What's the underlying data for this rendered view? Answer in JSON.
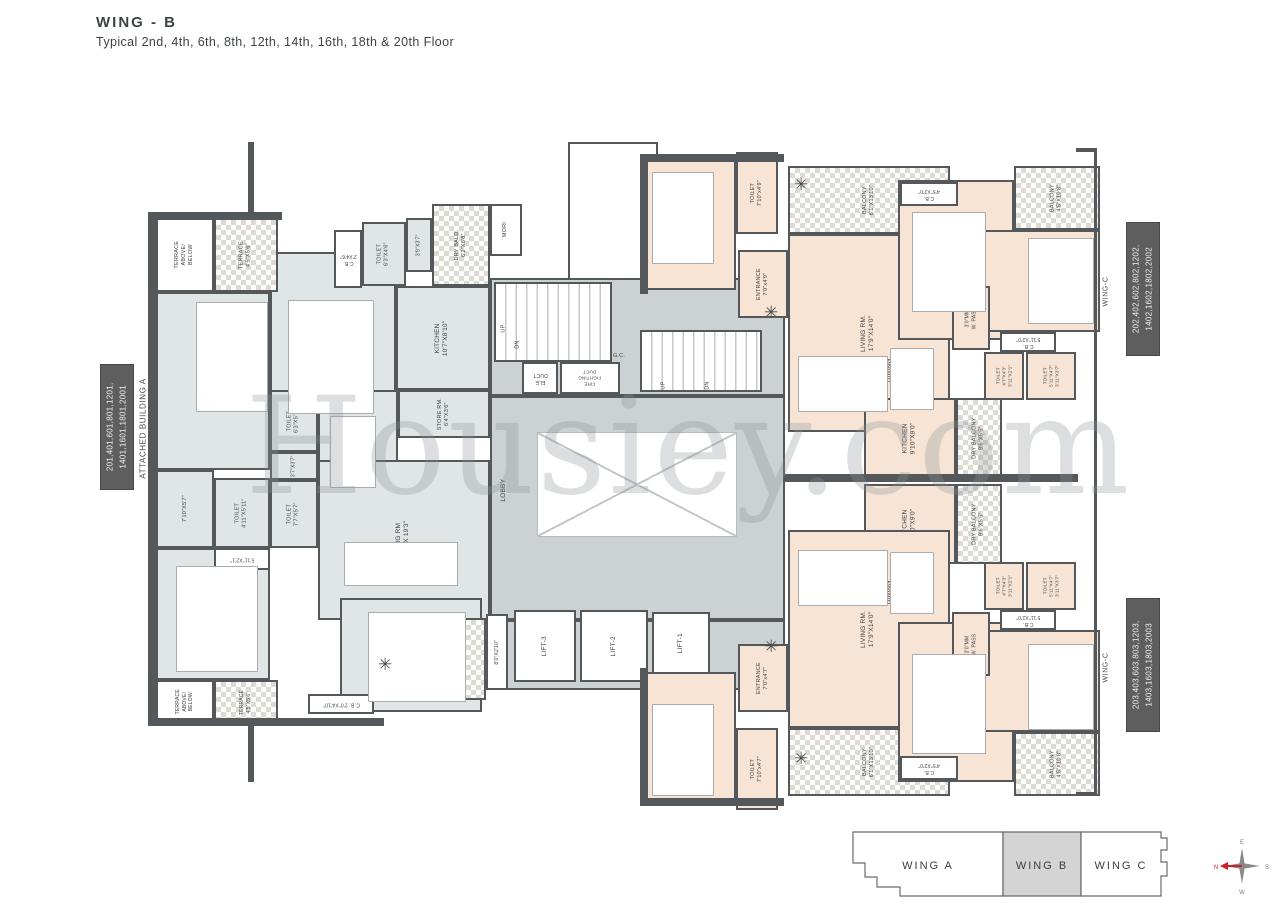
{
  "title": "WING - B",
  "subtitle": "Typical 2nd, 4th, 6th, 8th, 12th, 14th, 16th, 18th & 20th Floor",
  "watermark": "Housiey.com",
  "side_labels": {
    "left_units": "201,401,601,801,1201,\n1401,1601,1801,2001",
    "left_building": "ATTACHED BUILDING A",
    "right_top_units": "202,402,602,802,1202,\n1402,1602,1802,2002",
    "right_top_wing": "WING-C",
    "right_bottom_units": "203,403,603,803,1203,\n1403,1603,1803,2003",
    "right_bottom_wing": "WING-C"
  },
  "key_plan": {
    "wings": [
      {
        "label": "WING A",
        "active": false
      },
      {
        "label": "WING B",
        "active": true
      },
      {
        "label": "WING C",
        "active": false
      }
    ]
  },
  "compass": {
    "n": "N",
    "e": "E",
    "s": "S",
    "w": "W"
  },
  "colors": {
    "wall": "#54585a",
    "apartment_left_fill": "#e0e6e6",
    "apartment_right_fill": "#f7e4d5",
    "core_fill": "#ccd1d3",
    "unit_box": "#5e5e5e",
    "key_plan_active": "#d4d4d4",
    "compass_north": "#cc2222"
  },
  "plan": {
    "rooms": [
      {
        "n": "core-upper",
        "c": "core",
        "x": 490,
        "y": 278,
        "w": 295,
        "h": 118
      },
      {
        "n": "core-lobby",
        "c": "core",
        "x": 490,
        "y": 396,
        "w": 295,
        "h": 224
      },
      {
        "n": "core-lift-lobby",
        "c": "core",
        "x": 490,
        "y": 620,
        "w": 295,
        "h": 70
      },
      {
        "n": "kids-rm-01",
        "l": "KIDS RM.01\n14'0\"X12'0\"",
        "c": "aptL",
        "x": 156,
        "y": 292,
        "w": 114,
        "h": 178
      },
      {
        "n": "kids-rm-02",
        "l": "KIDS RM.02\n12'0\"X10'10\"",
        "c": "aptL",
        "x": 270,
        "y": 252,
        "w": 126,
        "h": 208
      },
      {
        "n": "kitchen",
        "l": "KITCHEN\n10'7\"X8'10\"",
        "c": "aptL",
        "x": 396,
        "y": 286,
        "w": 94,
        "h": 104
      },
      {
        "n": "dining",
        "l": "DINING\n11'0\"X9'11\"",
        "c": "aptL",
        "x": 318,
        "y": 390,
        "w": 80,
        "h": 100
      },
      {
        "n": "living-rm",
        "l": "LIVING RM\n20'4\" X 19'3\"",
        "c": "aptL",
        "x": 318,
        "y": 460,
        "w": 172,
        "h": 160
      },
      {
        "n": "m-bed-rm",
        "l": "M. BED RM\n14'0\"X12'0\"",
        "c": "aptL",
        "x": 156,
        "y": 548,
        "w": 114,
        "h": 132
      },
      {
        "n": "guest-bed-rm",
        "l": "GUEST BED RM\n12'4\"X10'8\"",
        "c": "aptL",
        "x": 340,
        "y": 598,
        "w": 142,
        "h": 114
      },
      {
        "n": "pass-master",
        "l": "7'10\"X5'7\"",
        "c": "aptL",
        "x": 156,
        "y": 470,
        "w": 58,
        "h": 78,
        "f": 5.5
      },
      {
        "n": "toilet-master",
        "l": "TOILET\n4'11\"X5'11\"",
        "c": "aptL",
        "x": 214,
        "y": 478,
        "w": 56,
        "h": 70,
        "f": 5.5
      },
      {
        "n": "cb-master",
        "l": "5'11\"X2'1\"",
        "c": "white",
        "x": 214,
        "y": 548,
        "w": 56,
        "h": 22,
        "r": 180,
        "f": 5
      },
      {
        "n": "toilet-common",
        "l": "TOILET\n6'3\"X5'7\"",
        "c": "aptL",
        "x": 270,
        "y": 390,
        "w": 48,
        "h": 62,
        "f": 5.5
      },
      {
        "n": "pass-toilets",
        "l": "3'7\"X3'7\"",
        "c": "aptL",
        "x": 270,
        "y": 452,
        "w": 48,
        "h": 28,
        "f": 5
      },
      {
        "n": "toilet-guest",
        "l": "TOILET\n7'7\"X5'7\"",
        "c": "aptL",
        "x": 270,
        "y": 480,
        "w": 48,
        "h": 68,
        "f": 5.5
      },
      {
        "n": "terrace-above-below-top",
        "l": "TERRACE\nABOVE/\nBELOW",
        "c": "white",
        "x": 156,
        "y": 218,
        "w": 58,
        "h": 74,
        "f": 5.5
      },
      {
        "n": "terrace-top",
        "l": "TERRACE\n4'5\"X5'6\"",
        "c": "hatch",
        "x": 214,
        "y": 218,
        "w": 64,
        "h": 74,
        "f": 5.5
      },
      {
        "n": "cb-kids",
        "l": "C.B.\n2'X4'6\"",
        "c": "white",
        "x": 334,
        "y": 230,
        "w": 28,
        "h": 58,
        "r": 180,
        "f": 5
      },
      {
        "n": "toilet-kids",
        "l": "TOILET\n6'3\"X4'6\"",
        "c": "aptL",
        "x": 362,
        "y": 222,
        "w": 44,
        "h": 64,
        "f": 5.5
      },
      {
        "n": "pass-kids",
        "l": "3'9\"X3'7\"",
        "c": "aptL",
        "x": 406,
        "y": 218,
        "w": 26,
        "h": 54,
        "f": 5
      },
      {
        "n": "dry-bald",
        "l": "DRY BALD.\n6'2\"X6'8\"",
        "c": "hatch",
        "x": 432,
        "y": 204,
        "w": 58,
        "h": 82,
        "f": 5.5
      },
      {
        "n": "mori",
        "l": "MORI",
        "c": "white",
        "x": 490,
        "y": 204,
        "w": 32,
        "h": 52,
        "f": 5.5
      },
      {
        "n": "store-rm",
        "l": "STORE RM.\n6'4\"X3'6\"",
        "c": "aptL",
        "x": 398,
        "y": 390,
        "w": 92,
        "h": 48,
        "f": 5.5
      },
      {
        "n": "terrace-above-below-bottom",
        "l": "TERRACE\nABOVE/\nBELOW",
        "c": "white",
        "x": 156,
        "y": 680,
        "w": 58,
        "h": 44,
        "f": 5
      },
      {
        "n": "terrace-bottom",
        "l": "TERRACE\n4'5\"X5'6\"",
        "c": "hatch",
        "x": 214,
        "y": 680,
        "w": 64,
        "h": 44,
        "f": 5
      },
      {
        "n": "cb-guest",
        "l": "C.B. 2'0\"X4'10\"",
        "c": "white",
        "x": 308,
        "y": 694,
        "w": 66,
        "h": 20,
        "r": 180,
        "f": 5
      },
      {
        "n": "balcony-left",
        "l": "BALCONY\n7'10\"X18'10\"",
        "c": "hatch",
        "x": 374,
        "y": 618,
        "w": 112,
        "h": 82,
        "f": 5.5
      },
      {
        "n": "ledge-left",
        "l": "8'0\"X2'10\"",
        "c": "white",
        "x": 486,
        "y": 614,
        "w": 22,
        "h": 76,
        "f": 5
      },
      {
        "n": "top-shaft",
        "c": "white",
        "x": 568,
        "y": 142,
        "w": 90,
        "h": 138
      },
      {
        "n": "bedroom1-top",
        "l": "BEDROOM-1\n12'0\"x10'8\"",
        "c": "aptR",
        "x": 646,
        "y": 160,
        "w": 90,
        "h": 130
      },
      {
        "n": "toilet1-top",
        "l": "TOILET\n7'10\"x4'9\"",
        "c": "aptR",
        "x": 736,
        "y": 152,
        "w": 42,
        "h": 82,
        "f": 5.5
      },
      {
        "n": "entrance-top",
        "l": "ENTRANCE\n7'0\"x4'9\"",
        "c": "aptR",
        "x": 738,
        "y": 250,
        "w": 50,
        "h": 68,
        "f": 5.5
      },
      {
        "n": "balcony1-top",
        "l": "BALCONY\n6'1\"X13'10\"",
        "c": "hatch",
        "x": 788,
        "y": 166,
        "w": 162,
        "h": 68,
        "f": 5.5
      },
      {
        "n": "living-top",
        "l": "LIVING RM.\n17'9\"X14'0\"",
        "c": "aptR",
        "x": 788,
        "y": 234,
        "w": 162,
        "h": 198
      },
      {
        "n": "bedroom2-top",
        "l": "BEDROOM-2\n12'4\"X10'0\"",
        "c": "aptR",
        "x": 898,
        "y": 180,
        "w": 116,
        "h": 160
      },
      {
        "n": "cb-bedroom2-top",
        "l": "C.B.\n4'5\"X2'0\"",
        "c": "white",
        "x": 900,
        "y": 182,
        "w": 58,
        "h": 24,
        "r": 180,
        "f": 5
      },
      {
        "n": "balcony2-top",
        "l": "BALCONY\n4'5\"X10'8\"",
        "c": "hatch",
        "x": 1014,
        "y": 166,
        "w": 86,
        "h": 64,
        "f": 5.5
      },
      {
        "n": "bedroom3-top",
        "l": "BEDROOM-3\n13'0\"X10'10\"",
        "c": "aptR",
        "x": 984,
        "y": 230,
        "w": 116,
        "h": 102
      },
      {
        "n": "cb-bedroom3-top",
        "l": "C.B.\n5'11\"X2'0\"",
        "c": "white",
        "x": 1000,
        "y": 332,
        "w": 56,
        "h": 20,
        "r": 180,
        "f": 5
      },
      {
        "n": "wide-pass-top",
        "l": "3'0\"MM\nW. PASS",
        "c": "aptR",
        "x": 952,
        "y": 286,
        "w": 38,
        "h": 64,
        "f": 5
      },
      {
        "n": "toilet-a-top",
        "l": "TOILET\n4'7\"X4'3\"\n3'11\"X2'1\"",
        "c": "aptR",
        "x": 984,
        "y": 352,
        "w": 40,
        "h": 48,
        "f": 4.5
      },
      {
        "n": "toilet-b-top",
        "l": "TOILET\n5'11\"X4'7\"\n3'11\"X3'7\"",
        "c": "aptR",
        "x": 1026,
        "y": 352,
        "w": 50,
        "h": 48,
        "f": 4.5
      },
      {
        "n": "kitchen-top",
        "l": "KITCHEN\n9'10\"X9'0\"",
        "c": "aptR",
        "x": 864,
        "y": 398,
        "w": 92,
        "h": 80
      },
      {
        "n": "dry-balcony-top",
        "l": "DRY BALCONY\n9'6\"X5'5\"",
        "c": "hatch",
        "x": 956,
        "y": 398,
        "w": 46,
        "h": 80,
        "f": 5.5
      },
      {
        "n": "kitchen-bottom",
        "l": "KITCHEN\n9'10\"X9'0\"",
        "c": "aptR",
        "x": 864,
        "y": 484,
        "w": 92,
        "h": 80
      },
      {
        "n": "dry-balcony-bottom",
        "l": "DRY BALCONY\n9'6\"X5'5\"",
        "c": "hatch",
        "x": 956,
        "y": 484,
        "w": 46,
        "h": 80,
        "f": 5.5
      },
      {
        "n": "living-bottom",
        "l": "LIVING RM.\n17'9\"X14'0\"",
        "c": "aptR",
        "x": 788,
        "y": 530,
        "w": 162,
        "h": 198
      },
      {
        "n": "entrance-bottom",
        "l": "ENTRANCE\n7'0\"x4'7\"",
        "c": "aptR",
        "x": 738,
        "y": 644,
        "w": 50,
        "h": 68,
        "f": 5.5
      },
      {
        "n": "bedroom1-bottom",
        "l": "BEDROOM-1\n12'2\"x10'0\"",
        "c": "aptR",
        "x": 646,
        "y": 672,
        "w": 90,
        "h": 130
      },
      {
        "n": "toilet1-bottom",
        "l": "TOILET\n7'10\"x4'7\"",
        "c": "aptR",
        "x": 736,
        "y": 728,
        "w": 42,
        "h": 82,
        "f": 5.5
      },
      {
        "n": "balcony1-bottom",
        "l": "BALCONY\n6'1\"X13'10\"",
        "c": "hatch",
        "x": 788,
        "y": 728,
        "w": 162,
        "h": 68,
        "f": 5.5
      },
      {
        "n": "bedroom2-bottom",
        "l": "BEDROOM-2\n12'4\"X10'0\"",
        "c": "aptR",
        "x": 898,
        "y": 622,
        "w": 116,
        "h": 160
      },
      {
        "n": "cb-bedroom2-bottom",
        "l": "C.B.\n4'5\"X2'0\"",
        "c": "white",
        "x": 900,
        "y": 756,
        "w": 58,
        "h": 24,
        "r": 180,
        "f": 5
      },
      {
        "n": "balcony2-bottom",
        "l": "BALCONY\n4'5\"X10'8\"",
        "c": "hatch",
        "x": 1014,
        "y": 732,
        "w": 86,
        "h": 64,
        "f": 5.5
      },
      {
        "n": "bedroom3-bottom",
        "l": "BEDROOM-3\n13'0\"X10'10\"",
        "c": "aptR",
        "x": 984,
        "y": 630,
        "w": 116,
        "h": 102
      },
      {
        "n": "cb-bedroom3-bottom",
        "l": "C.B.\n5'11\"X2'0\"",
        "c": "white",
        "x": 1000,
        "y": 610,
        "w": 56,
        "h": 20,
        "r": 180,
        "f": 5
      },
      {
        "n": "wide-pass-bottom",
        "l": "3'0\"MM\nW. PASS",
        "c": "aptR",
        "x": 952,
        "y": 612,
        "w": 38,
        "h": 64,
        "f": 5
      },
      {
        "n": "toilet-a-bottom",
        "l": "TOILET\n4'7\"X4'3\"\n3'11\"X2'1\"",
        "c": "aptR",
        "x": 984,
        "y": 562,
        "w": 40,
        "h": 48,
        "f": 4.5
      },
      {
        "n": "toilet-b-bottom",
        "l": "TOILET\n5'11\"X4'7\"\n3'11\"X3'7\"",
        "c": "aptR",
        "x": 1026,
        "y": 562,
        "w": 50,
        "h": 48,
        "f": 4.5
      },
      {
        "n": "staircase-1",
        "c": "stairs",
        "x": 494,
        "y": 282,
        "w": 118,
        "h": 80
      },
      {
        "n": "staircase-2",
        "c": "stairs",
        "x": 640,
        "y": 330,
        "w": 122,
        "h": 62
      },
      {
        "n": "ele-duct",
        "l": "ELE\nDUCT",
        "c": "white",
        "x": 522,
        "y": 362,
        "w": 36,
        "h": 32,
        "r": 180,
        "f": 5
      },
      {
        "n": "fire-fighting-duct",
        "l": "FIRE\nFIGHTING\nDUCT",
        "c": "white",
        "x": 560,
        "y": 362,
        "w": 60,
        "h": 32,
        "r": 180,
        "f": 4.5
      },
      {
        "n": "open-cutout",
        "c": "cut",
        "x": 537,
        "y": 432,
        "w": 200,
        "h": 105
      },
      {
        "n": "lift-3",
        "l": "LIFT-3",
        "c": "white",
        "x": 514,
        "y": 610,
        "w": 62,
        "h": 72,
        "f": 6.5
      },
      {
        "n": "lift-2",
        "l": "LIFT-2",
        "c": "white",
        "x": 580,
        "y": 610,
        "w": 68,
        "h": 72,
        "f": 6.5
      },
      {
        "n": "lift-1",
        "l": "LIFT-1",
        "c": "white",
        "x": 652,
        "y": 612,
        "w": 58,
        "h": 62,
        "f": 6.5
      },
      {
        "n": "dining-top",
        "l": "DINING\n9'6\"X5'9\"",
        "c": "txt",
        "x": 872,
        "y": 330,
        "w": 44,
        "h": 80
      },
      {
        "n": "dining-bottom",
        "l": "DINING\n9'6\"X5'9\"",
        "c": "txt",
        "x": 872,
        "y": 552,
        "w": 44,
        "h": 80
      },
      {
        "n": "stair1-up",
        "l": "UP",
        "c": "txt",
        "x": 496,
        "y": 316,
        "w": 16,
        "h": 26,
        "f": 5.5
      },
      {
        "n": "stair1-dn",
        "l": "DN",
        "c": "txt",
        "x": 510,
        "y": 332,
        "w": 16,
        "h": 26,
        "f": 5.5
      },
      {
        "n": "gc",
        "l": "G.C.",
        "c": "txt",
        "x": 608,
        "y": 350,
        "w": 22,
        "h": 14,
        "r": 0,
        "f": 5.5
      },
      {
        "n": "stair2-up",
        "l": "UP",
        "c": "txt",
        "x": 656,
        "y": 374,
        "w": 16,
        "h": 24,
        "f": 5.5
      },
      {
        "n": "stair2-dn",
        "l": "DN",
        "c": "txt",
        "x": 700,
        "y": 374,
        "w": 16,
        "h": 24,
        "f": 5.5
      },
      {
        "n": "lobby",
        "l": "LOBBY",
        "c": "txt",
        "x": 494,
        "y": 460,
        "w": 20,
        "h": 60,
        "f": 6.5
      }
    ],
    "walls": [
      {
        "x": 148,
        "y": 212,
        "w": 8,
        "h": 514
      },
      {
        "x": 148,
        "y": 212,
        "w": 134,
        "h": 8
      },
      {
        "x": 148,
        "y": 718,
        "w": 236,
        "h": 8
      },
      {
        "x": 640,
        "y": 154,
        "w": 8,
        "h": 140
      },
      {
        "x": 640,
        "y": 154,
        "w": 144,
        "h": 8
      },
      {
        "x": 784,
        "y": 474,
        "w": 294,
        "h": 8
      },
      {
        "x": 640,
        "y": 668,
        "w": 8,
        "h": 138
      },
      {
        "x": 640,
        "y": 798,
        "w": 144,
        "h": 8
      },
      {
        "x": 248,
        "y": 142,
        "w": 6,
        "h": 72
      },
      {
        "x": 248,
        "y": 724,
        "w": 6,
        "h": 58
      },
      {
        "x": 1094,
        "y": 148,
        "w": 3,
        "h": 648
      },
      {
        "x": 1076,
        "y": 148,
        "w": 20,
        "h": 4
      },
      {
        "x": 1076,
        "y": 792,
        "w": 20,
        "h": 4
      }
    ],
    "furniture": [
      {
        "k": "bed",
        "x": 196,
        "y": 302,
        "w": 70,
        "h": 108
      },
      {
        "k": "bed",
        "x": 288,
        "y": 300,
        "w": 84,
        "h": 112
      },
      {
        "k": "bed",
        "x": 176,
        "y": 566,
        "w": 80,
        "h": 104
      },
      {
        "k": "bed",
        "x": 368,
        "y": 612,
        "w": 96,
        "h": 88
      },
      {
        "k": "bed",
        "x": 652,
        "y": 172,
        "w": 60,
        "h": 90
      },
      {
        "k": "bed",
        "x": 912,
        "y": 212,
        "w": 72,
        "h": 98
      },
      {
        "k": "bed",
        "x": 1028,
        "y": 238,
        "w": 64,
        "h": 84
      },
      {
        "k": "bed",
        "x": 652,
        "y": 704,
        "w": 60,
        "h": 90
      },
      {
        "k": "bed",
        "x": 912,
        "y": 654,
        "w": 72,
        "h": 98
      },
      {
        "k": "bed",
        "x": 1028,
        "y": 644,
        "w": 64,
        "h": 84
      },
      {
        "k": "sofa",
        "x": 344,
        "y": 542,
        "w": 112,
        "h": 42
      },
      {
        "k": "dining-table",
        "x": 330,
        "y": 416,
        "w": 44,
        "h": 70
      },
      {
        "k": "sofa",
        "x": 798,
        "y": 356,
        "w": 88,
        "h": 54
      },
      {
        "k": "dining-table",
        "x": 890,
        "y": 348,
        "w": 42,
        "h": 60
      },
      {
        "k": "sofa",
        "x": 798,
        "y": 550,
        "w": 88,
        "h": 54
      },
      {
        "k": "dining-table",
        "x": 890,
        "y": 552,
        "w": 42,
        "h": 60
      }
    ],
    "plants": [
      {
        "x": 794,
        "y": 176
      },
      {
        "x": 764,
        "y": 304
      },
      {
        "x": 378,
        "y": 656
      },
      {
        "x": 764,
        "y": 638
      },
      {
        "x": 794,
        "y": 750
      }
    ]
  }
}
